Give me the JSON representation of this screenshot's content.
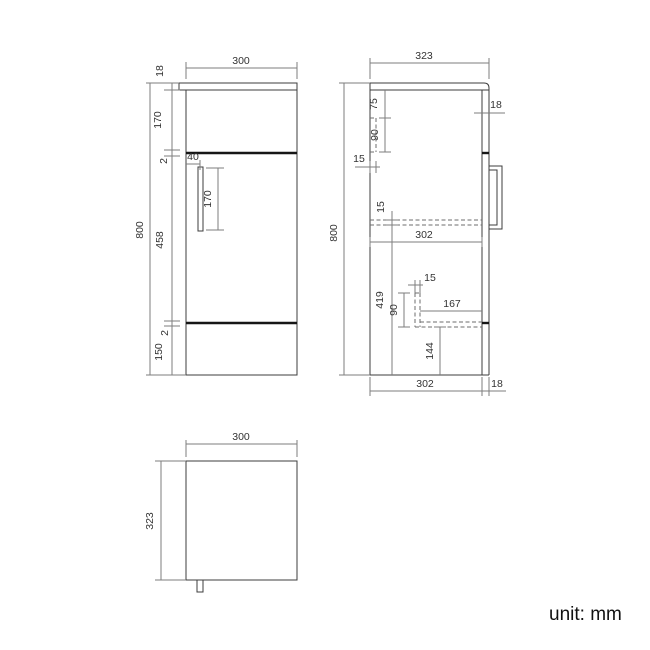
{
  "page": {
    "background": "#ffffff",
    "unit_label": "unit: mm"
  },
  "palette": {
    "object_line": "#3c3c3c",
    "dimension_line": "#7d7d7d",
    "hidden_line": "#6e6e6e",
    "thick_gap_line": "#161616",
    "label_text": "#333333"
  },
  "views": [
    {
      "label": "front-view",
      "dimensions_mm": {
        "overall_width": "300",
        "overall_height": "800",
        "top_thickness": "18",
        "upper_section": "170",
        "upper_gap": "2",
        "door_height": "458",
        "lower_gap": "2",
        "bottom_section": "150",
        "handle_offset": "40",
        "handle_length": "170"
      }
    },
    {
      "label": "side-view",
      "dimensions_mm": {
        "overall_depth": "323",
        "overall_height": "800",
        "bracket_top_offset": "75",
        "bracket_height": "90",
        "back_panel_thickness": "15",
        "shelf_thickness": "15",
        "internal_depth": "302",
        "shelf_to_bottom": "419",
        "support_width": "15",
        "support_height": "90",
        "recess_depth": "167",
        "recess_height": "144",
        "internal_depth_bottom": "302",
        "front_panel_thickness": "18",
        "panel_thickness": "18"
      }
    },
    {
      "label": "top-view",
      "dimensions_mm": {
        "overall_width": "300",
        "overall_depth": "323"
      }
    }
  ],
  "figure": {
    "width": 650,
    "height": 650,
    "elements": [
      {
        "n": "front-view-countertop",
        "t": "rect",
        "c": "object",
        "x": 179,
        "y": 83,
        "w": 118,
        "h": 7
      },
      {
        "n": "front-view-body",
        "t": "rect",
        "c": "object",
        "x": 186,
        "y": 90,
        "w": 111,
        "h": 285
      },
      {
        "n": "front-view-door-gap-top",
        "t": "line",
        "c": "thick",
        "x1": 186,
        "y1": 153,
        "x2": 297,
        "y2": 153
      },
      {
        "n": "front-view-door-gap-bottom",
        "t": "line",
        "c": "thick",
        "x1": 186,
        "y1": 323,
        "x2": 297,
        "y2": 323
      },
      {
        "n": "front-view-handle",
        "t": "rect",
        "c": "object",
        "x": 198,
        "y": 167,
        "w": 5,
        "h": 64
      },
      {
        "n": "front-width-ext-left",
        "t": "line",
        "c": "dim",
        "x1": 186,
        "y1": 79,
        "x2": 186,
        "y2": 62
      },
      {
        "n": "front-width-ext-right",
        "t": "line",
        "c": "dim",
        "x1": 297,
        "y1": 79,
        "x2": 297,
        "y2": 62
      },
      {
        "n": "front-width-dimline",
        "t": "line",
        "c": "dim",
        "x1": 186,
        "y1": 68,
        "x2": 297,
        "y2": 68
      },
      {
        "n": "front-width-label",
        "t": "text",
        "x": 241,
        "y": 64,
        "label": "300"
      },
      {
        "n": "front-height-dimline",
        "t": "line",
        "c": "dim",
        "x1": 150,
        "y1": 83,
        "x2": 150,
        "y2": 375
      },
      {
        "n": "front-height-tick-top",
        "t": "line",
        "c": "dim",
        "x1": 146,
        "y1": 83,
        "x2": 179,
        "y2": 83
      },
      {
        "n": "front-height-tick-bottom",
        "t": "line",
        "c": "dim",
        "x1": 146,
        "y1": 375,
        "x2": 186,
        "y2": 375
      },
      {
        "n": "front-height-label",
        "t": "text",
        "x": 143,
        "y": 230,
        "label": "800",
        "rot": true
      },
      {
        "n": "front-stack-dimline",
        "t": "line",
        "c": "dim",
        "x1": 172,
        "y1": 83,
        "x2": 172,
        "y2": 375
      },
      {
        "n": "front-stack-tick-90",
        "t": "line",
        "c": "dim",
        "x1": 164,
        "y1": 90,
        "x2": 180,
        "y2": 90
      },
      {
        "n": "front-stack-tick-150",
        "t": "line",
        "c": "dim",
        "x1": 164,
        "y1": 150,
        "x2": 180,
        "y2": 150
      },
      {
        "n": "front-stack-tick-156",
        "t": "line",
        "c": "dim",
        "x1": 164,
        "y1": 156,
        "x2": 180,
        "y2": 156
      },
      {
        "n": "front-stack-tick-321",
        "t": "line",
        "c": "dim",
        "x1": 164,
        "y1": 321,
        "x2": 180,
        "y2": 321
      },
      {
        "n": "front-stack-tick-326",
        "t": "line",
        "c": "dim",
        "x1": 164,
        "y1": 326,
        "x2": 180,
        "y2": 326
      },
      {
        "n": "front-top-thickness-label",
        "t": "text",
        "x": 163,
        "y": 71,
        "label": "18",
        "rot": true
      },
      {
        "n": "front-upper-section-label",
        "t": "text",
        "x": 161,
        "y": 120,
        "label": "170",
        "rot": true
      },
      {
        "n": "front-upper-gap-label",
        "t": "text",
        "x": 167,
        "y": 161,
        "label": "2",
        "rot": true
      },
      {
        "n": "front-door-height-label",
        "t": "text",
        "x": 163,
        "y": 240,
        "label": "458",
        "rot": true
      },
      {
        "n": "front-lower-gap-label",
        "t": "text",
        "x": 168,
        "y": 333,
        "label": "2",
        "rot": true
      },
      {
        "n": "front-bottom-section-label",
        "t": "text",
        "x": 162,
        "y": 352,
        "label": "150",
        "rot": true
      },
      {
        "n": "front-handle-offset-dimline",
        "t": "line",
        "c": "dim",
        "x1": 186,
        "y1": 164,
        "x2": 200,
        "y2": 164
      },
      {
        "n": "front-handle-offset-tick",
        "t": "line",
        "c": "dim",
        "x1": 200,
        "y1": 160,
        "x2": 200,
        "y2": 170
      },
      {
        "n": "front-handle-offset-label",
        "t": "text",
        "x": 193,
        "y": 160,
        "label": "40"
      },
      {
        "n": "front-handle-length-dimline",
        "t": "line",
        "c": "dim",
        "x1": 218,
        "y1": 168,
        "x2": 218,
        "y2": 230
      },
      {
        "n": "front-handle-length-tick-top",
        "t": "line",
        "c": "dim",
        "x1": 206,
        "y1": 168,
        "x2": 224,
        "y2": 168
      },
      {
        "n": "front-handle-length-tick-bottom",
        "t": "line",
        "c": "dim",
        "x1": 206,
        "y1": 230,
        "x2": 224,
        "y2": 230
      },
      {
        "n": "front-handle-length-label",
        "t": "text",
        "x": 211,
        "y": 199,
        "label": "170",
        "rot": true
      },
      {
        "n": "side-view-countertop",
        "t": "path",
        "c": "object",
        "d": "M370,90 L370,83 L484,83 Q489,83 489,88 L489,90 L370,90"
      },
      {
        "n": "side-view-back-line",
        "t": "line",
        "c": "object",
        "x1": 370,
        "y1": 90,
        "x2": 370,
        "y2": 375
      },
      {
        "n": "side-view-bottom-line",
        "t": "line",
        "c": "object",
        "x1": 370,
        "y1": 375,
        "x2": 489,
        "y2": 375
      },
      {
        "n": "side-view-front-inner-line",
        "t": "line",
        "c": "object",
        "x1": 482,
        "y1": 90,
        "x2": 482,
        "y2": 375
      },
      {
        "n": "side-view-front-outer-line",
        "t": "line",
        "c": "object",
        "x1": 489,
        "y1": 90,
        "x2": 489,
        "y2": 375
      },
      {
        "n": "side-view-gap-mark-top",
        "t": "line",
        "c": "thick",
        "x1": 482,
        "y1": 153,
        "x2": 489,
        "y2": 153
      },
      {
        "n": "side-view-gap-mark-bottom",
        "t": "line",
        "c": "thick",
        "x1": 482,
        "y1": 323,
        "x2": 489,
        "y2": 323
      },
      {
        "n": "side-view-handle-outer",
        "t": "rect",
        "c": "object",
        "x": 489,
        "y": 166,
        "w": 13,
        "h": 63
      },
      {
        "n": "side-view-handle-inner",
        "t": "rect",
        "c": "object",
        "x": 489,
        "y": 170,
        "w": 8,
        "h": 55
      },
      {
        "n": "side-bracket-hidden-right",
        "t": "line",
        "c": "dash",
        "x1": 376,
        "y1": 118,
        "x2": 376,
        "y2": 152
      },
      {
        "n": "side-bracket-hidden-top",
        "t": "line",
        "c": "dash",
        "x1": 370,
        "y1": 118,
        "x2": 376,
        "y2": 118
      },
      {
        "n": "side-bracket-hidden-bottom",
        "t": "line",
        "c": "dash",
        "x1": 370,
        "y1": 152,
        "x2": 376,
        "y2": 152
      },
      {
        "n": "side-shelf-hidden-top",
        "t": "line",
        "c": "dash",
        "x1": 370,
        "y1": 220,
        "x2": 482,
        "y2": 220
      },
      {
        "n": "side-shelf-hidden-bottom",
        "t": "line",
        "c": "dash",
        "x1": 370,
        "y1": 225,
        "x2": 482,
        "y2": 225
      },
      {
        "n": "side-support-hidden-left",
        "t": "line",
        "c": "dash",
        "x1": 415,
        "y1": 293,
        "x2": 415,
        "y2": 327
      },
      {
        "n": "side-support-hidden-right",
        "t": "line",
        "c": "dash",
        "x1": 420,
        "y1": 293,
        "x2": 420,
        "y2": 327
      },
      {
        "n": "side-support-hidden-cap",
        "t": "line",
        "c": "dash",
        "x1": 415,
        "y1": 293,
        "x2": 420,
        "y2": 293
      },
      {
        "n": "side-recess-hidden-top",
        "t": "line",
        "c": "dash",
        "x1": 420,
        "y1": 322,
        "x2": 482,
        "y2": 322
      },
      {
        "n": "side-recess-hidden-bottom",
        "t": "line",
        "c": "dash",
        "x1": 415,
        "y1": 327,
        "x2": 482,
        "y2": 327
      },
      {
        "n": "side-depth-ext-left",
        "t": "line",
        "c": "dim",
        "x1": 370,
        "y1": 79,
        "x2": 370,
        "y2": 58
      },
      {
        "n": "side-depth-ext-right",
        "t": "line",
        "c": "dim",
        "x1": 489,
        "y1": 79,
        "x2": 489,
        "y2": 58
      },
      {
        "n": "side-depth-dimline",
        "t": "line",
        "c": "dim",
        "x1": 370,
        "y1": 63,
        "x2": 489,
        "y2": 63
      },
      {
        "n": "side-depth-label",
        "t": "text",
        "x": 424,
        "y": 59,
        "label": "323"
      },
      {
        "n": "side-height-dimline",
        "t": "line",
        "c": "dim",
        "x1": 344,
        "y1": 83,
        "x2": 344,
        "y2": 375
      },
      {
        "n": "side-height-tick-top",
        "t": "line",
        "c": "dim",
        "x1": 339,
        "y1": 83,
        "x2": 370,
        "y2": 83
      },
      {
        "n": "side-height-tick-bottom",
        "t": "line",
        "c": "dim",
        "x1": 339,
        "y1": 375,
        "x2": 370,
        "y2": 375
      },
      {
        "n": "side-height-label",
        "t": "text",
        "x": 337,
        "y": 233,
        "label": "800",
        "rot": true
      },
      {
        "n": "side-bracket-offset-dimline",
        "t": "line",
        "c": "dim",
        "x1": 385,
        "y1": 90,
        "x2": 385,
        "y2": 118
      },
      {
        "n": "side-bracket-offset-tick",
        "t": "line",
        "c": "dim",
        "x1": 379,
        "y1": 118,
        "x2": 391,
        "y2": 118
      },
      {
        "n": "side-bracket-offset-label",
        "t": "text",
        "x": 377,
        "y": 104,
        "label": "75",
        "rot": true
      },
      {
        "n": "side-bracket-height-dimline",
        "t": "line",
        "c": "dim",
        "x1": 385,
        "y1": 118,
        "x2": 385,
        "y2": 152
      },
      {
        "n": "side-bracket-height-tick",
        "t": "line",
        "c": "dim",
        "x1": 379,
        "y1": 152,
        "x2": 391,
        "y2": 152
      },
      {
        "n": "side-bracket-height-label",
        "t": "text",
        "x": 378,
        "y": 135,
        "label": "90",
        "rot": true
      },
      {
        "n": "side-backpanel-dimline",
        "t": "line",
        "c": "dim",
        "x1": 355,
        "y1": 167,
        "x2": 380,
        "y2": 167
      },
      {
        "n": "side-backpanel-tick-left",
        "t": "line",
        "c": "dim",
        "x1": 370,
        "y1": 161,
        "x2": 370,
        "y2": 173
      },
      {
        "n": "side-backpanel-tick-right",
        "t": "line",
        "c": "dim",
        "x1": 376,
        "y1": 161,
        "x2": 376,
        "y2": 173
      },
      {
        "n": "side-backpanel-label",
        "t": "text",
        "x": 359,
        "y": 162,
        "label": "15"
      },
      {
        "n": "side-shelf-thickness-dimline",
        "t": "line",
        "c": "dim",
        "x1": 392,
        "y1": 211,
        "x2": 392,
        "y2": 225
      },
      {
        "n": "side-shelf-thickness-tick-top",
        "t": "line",
        "c": "dim",
        "x1": 386,
        "y1": 220,
        "x2": 398,
        "y2": 220
      },
      {
        "n": "side-shelf-thickness-tick-bottom",
        "t": "line",
        "c": "dim",
        "x1": 386,
        "y1": 225,
        "x2": 398,
        "y2": 225
      },
      {
        "n": "side-shelf-thickness-label",
        "t": "text",
        "x": 384,
        "y": 207,
        "label": "15",
        "rot": true
      },
      {
        "n": "side-internal-depth-dimline",
        "t": "line",
        "c": "dim",
        "x1": 370,
        "y1": 242,
        "x2": 482,
        "y2": 242
      },
      {
        "n": "side-internal-depth-tick-left",
        "t": "line",
        "c": "dim",
        "x1": 370,
        "y1": 237,
        "x2": 370,
        "y2": 247
      },
      {
        "n": "side-internal-depth-tick-right",
        "t": "line",
        "c": "dim",
        "x1": 482,
        "y1": 237,
        "x2": 482,
        "y2": 247
      },
      {
        "n": "side-internal-depth-label",
        "t": "text",
        "x": 424,
        "y": 238,
        "label": "302"
      },
      {
        "n": "side-shelf-to-bottom-dimline",
        "t": "line",
        "c": "dim",
        "x1": 392,
        "y1": 225,
        "x2": 392,
        "y2": 375
      },
      {
        "n": "side-shelf-to-bottom-label",
        "t": "text",
        "x": 383,
        "y": 300,
        "label": "419",
        "rot": true
      },
      {
        "n": "side-support-width-dimline",
        "t": "line",
        "c": "dim",
        "x1": 408,
        "y1": 285,
        "x2": 423,
        "y2": 285
      },
      {
        "n": "side-support-width-ext-left",
        "t": "line",
        "c": "dim",
        "x1": 415,
        "y1": 280,
        "x2": 415,
        "y2": 293
      },
      {
        "n": "side-support-width-ext-right",
        "t": "line",
        "c": "dim",
        "x1": 420,
        "y1": 280,
        "x2": 420,
        "y2": 293
      },
      {
        "n": "side-support-width-label",
        "t": "text",
        "x": 430,
        "y": 281,
        "label": "15"
      },
      {
        "n": "side-support-height-dimline",
        "t": "line",
        "c": "dim",
        "x1": 404,
        "y1": 293,
        "x2": 404,
        "y2": 327
      },
      {
        "n": "side-support-height-tick-top",
        "t": "line",
        "c": "dim",
        "x1": 398,
        "y1": 293,
        "x2": 410,
        "y2": 293
      },
      {
        "n": "side-support-height-tick-bottom",
        "t": "line",
        "c": "dim",
        "x1": 398,
        "y1": 327,
        "x2": 410,
        "y2": 327
      },
      {
        "n": "side-support-height-label",
        "t": "text",
        "x": 397,
        "y": 310,
        "label": "90",
        "rot": true
      },
      {
        "n": "side-recess-depth-dimline",
        "t": "line",
        "c": "dim",
        "x1": 420,
        "y1": 311,
        "x2": 482,
        "y2": 311
      },
      {
        "n": "side-recess-depth-label",
        "t": "text",
        "x": 452,
        "y": 307,
        "label": "167"
      },
      {
        "n": "side-recess-height-dimline",
        "t": "line",
        "c": "dim",
        "x1": 440,
        "y1": 327,
        "x2": 440,
        "y2": 375
      },
      {
        "n": "side-recess-height-tick",
        "t": "line",
        "c": "dim",
        "x1": 434,
        "y1": 327,
        "x2": 446,
        "y2": 327
      },
      {
        "n": "side-recess-height-label",
        "t": "text",
        "x": 433,
        "y": 351,
        "label": "144",
        "rot": true
      },
      {
        "n": "side-bottom-depth-ext-left",
        "t": "line",
        "c": "dim",
        "x1": 370,
        "y1": 377,
        "x2": 370,
        "y2": 396
      },
      {
        "n": "side-bottom-depth-ext-mid",
        "t": "line",
        "c": "dim",
        "x1": 482,
        "y1": 377,
        "x2": 482,
        "y2": 396
      },
      {
        "n": "side-bottom-depth-ext-right",
        "t": "line",
        "c": "dim",
        "x1": 489,
        "y1": 377,
        "x2": 489,
        "y2": 396
      },
      {
        "n": "side-bottom-depth-dimline",
        "t": "line",
        "c": "dim",
        "x1": 370,
        "y1": 391,
        "x2": 482,
        "y2": 391
      },
      {
        "n": "side-bottom-depth-label",
        "t": "text",
        "x": 425,
        "y": 387,
        "label": "302"
      },
      {
        "n": "side-bottom-front-dimline",
        "t": "line",
        "c": "dim",
        "x1": 482,
        "y1": 391,
        "x2": 506,
        "y2": 391
      },
      {
        "n": "side-bottom-front-label",
        "t": "text",
        "x": 497,
        "y": 387,
        "label": "18"
      },
      {
        "n": "side-panel-thickness-dimline",
        "t": "line",
        "c": "dim",
        "x1": 474,
        "y1": 113,
        "x2": 505,
        "y2": 113
      },
      {
        "n": "side-panel-thickness-label",
        "t": "text",
        "x": 496,
        "y": 108,
        "label": "18"
      },
      {
        "n": "top-view-body",
        "t": "rect",
        "c": "object",
        "x": 186,
        "y": 461,
        "w": 111,
        "h": 119
      },
      {
        "n": "top-view-handle",
        "t": "rect",
        "c": "object",
        "x": 197,
        "y": 580,
        "w": 6,
        "h": 12
      },
      {
        "n": "top-width-ext-left",
        "t": "line",
        "c": "dim",
        "x1": 186,
        "y1": 457,
        "x2": 186,
        "y2": 440
      },
      {
        "n": "top-width-ext-right",
        "t": "line",
        "c": "dim",
        "x1": 297,
        "y1": 457,
        "x2": 297,
        "y2": 440
      },
      {
        "n": "top-width-dimline",
        "t": "line",
        "c": "dim",
        "x1": 186,
        "y1": 444,
        "x2": 297,
        "y2": 444
      },
      {
        "n": "top-width-label",
        "t": "text",
        "x": 241,
        "y": 440,
        "label": "300"
      },
      {
        "n": "top-depth-tick-top",
        "t": "line",
        "c": "dim",
        "x1": 155,
        "y1": 461,
        "x2": 186,
        "y2": 461
      },
      {
        "n": "top-depth-tick-bottom",
        "t": "line",
        "c": "dim",
        "x1": 155,
        "y1": 580,
        "x2": 186,
        "y2": 580
      },
      {
        "n": "top-depth-dimline",
        "t": "line",
        "c": "dim",
        "x1": 161,
        "y1": 461,
        "x2": 161,
        "y2": 580
      },
      {
        "n": "top-depth-label",
        "t": "text",
        "x": 153,
        "y": 521,
        "label": "323",
        "rot": true
      }
    ]
  }
}
